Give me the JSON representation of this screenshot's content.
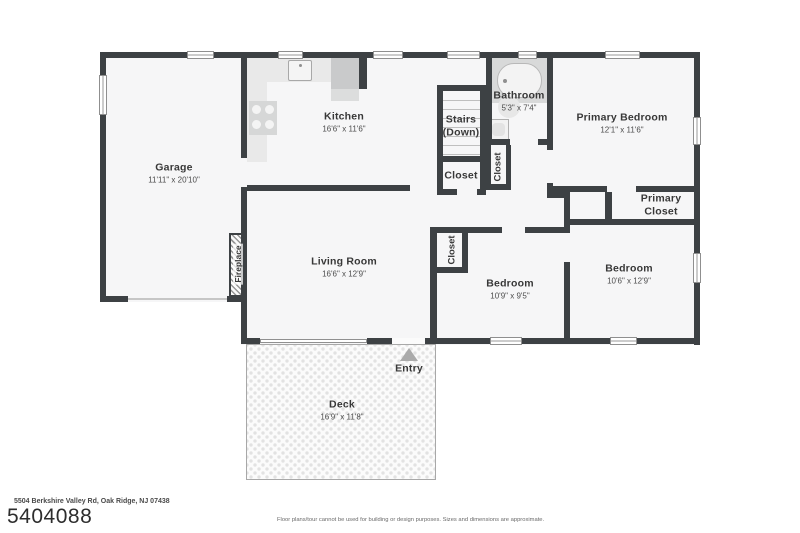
{
  "floorplan": {
    "rooms": {
      "garage": {
        "name": "Garage",
        "dims": "11'11\" x 20'10\""
      },
      "kitchen": {
        "name": "Kitchen",
        "dims": "16'6\" x 11'6\""
      },
      "stairs": {
        "name_line1": "Stairs",
        "name_line2": "(Down)"
      },
      "stair_closet": {
        "name": "Closet"
      },
      "hall_closet": {
        "name": "Closet"
      },
      "bathroom": {
        "name": "Bathroom",
        "dims": "5'3\" x 7'4\""
      },
      "primary_bedroom": {
        "name": "Primary Bedroom",
        "dims": "12'1\" x 11'6\""
      },
      "primary_closet": {
        "name_line1": "Primary",
        "name_line2": "Closet"
      },
      "bedroom_right": {
        "name": "Bedroom",
        "dims": "10'6\" x 12'9\""
      },
      "bedroom_middle": {
        "name": "Bedroom",
        "dims": "10'9\" x 9'5\""
      },
      "bedroom_closet": {
        "name": "Closet"
      },
      "living_room": {
        "name": "Living Room",
        "dims": "16'6\" x 12'9\""
      },
      "fireplace": {
        "name": "Fireplace"
      },
      "deck": {
        "name": "Deck",
        "dims": "16'9\" x 11'8\""
      },
      "entry": {
        "name": "Entry"
      }
    },
    "colors": {
      "wall": "#3d4144",
      "floor": "#f6f6f7",
      "fixture_light": "#e9e9e9",
      "fixture_dark": "#c9cacb"
    }
  },
  "footer": {
    "address": "5504 Berkshire Valley Rd, Oak Ridge, NJ 07438",
    "listing_id": "5404088",
    "disclaimer": "Floor plans/tour cannot be used for building or design purposes. Sizes and dimensions are approximate."
  }
}
